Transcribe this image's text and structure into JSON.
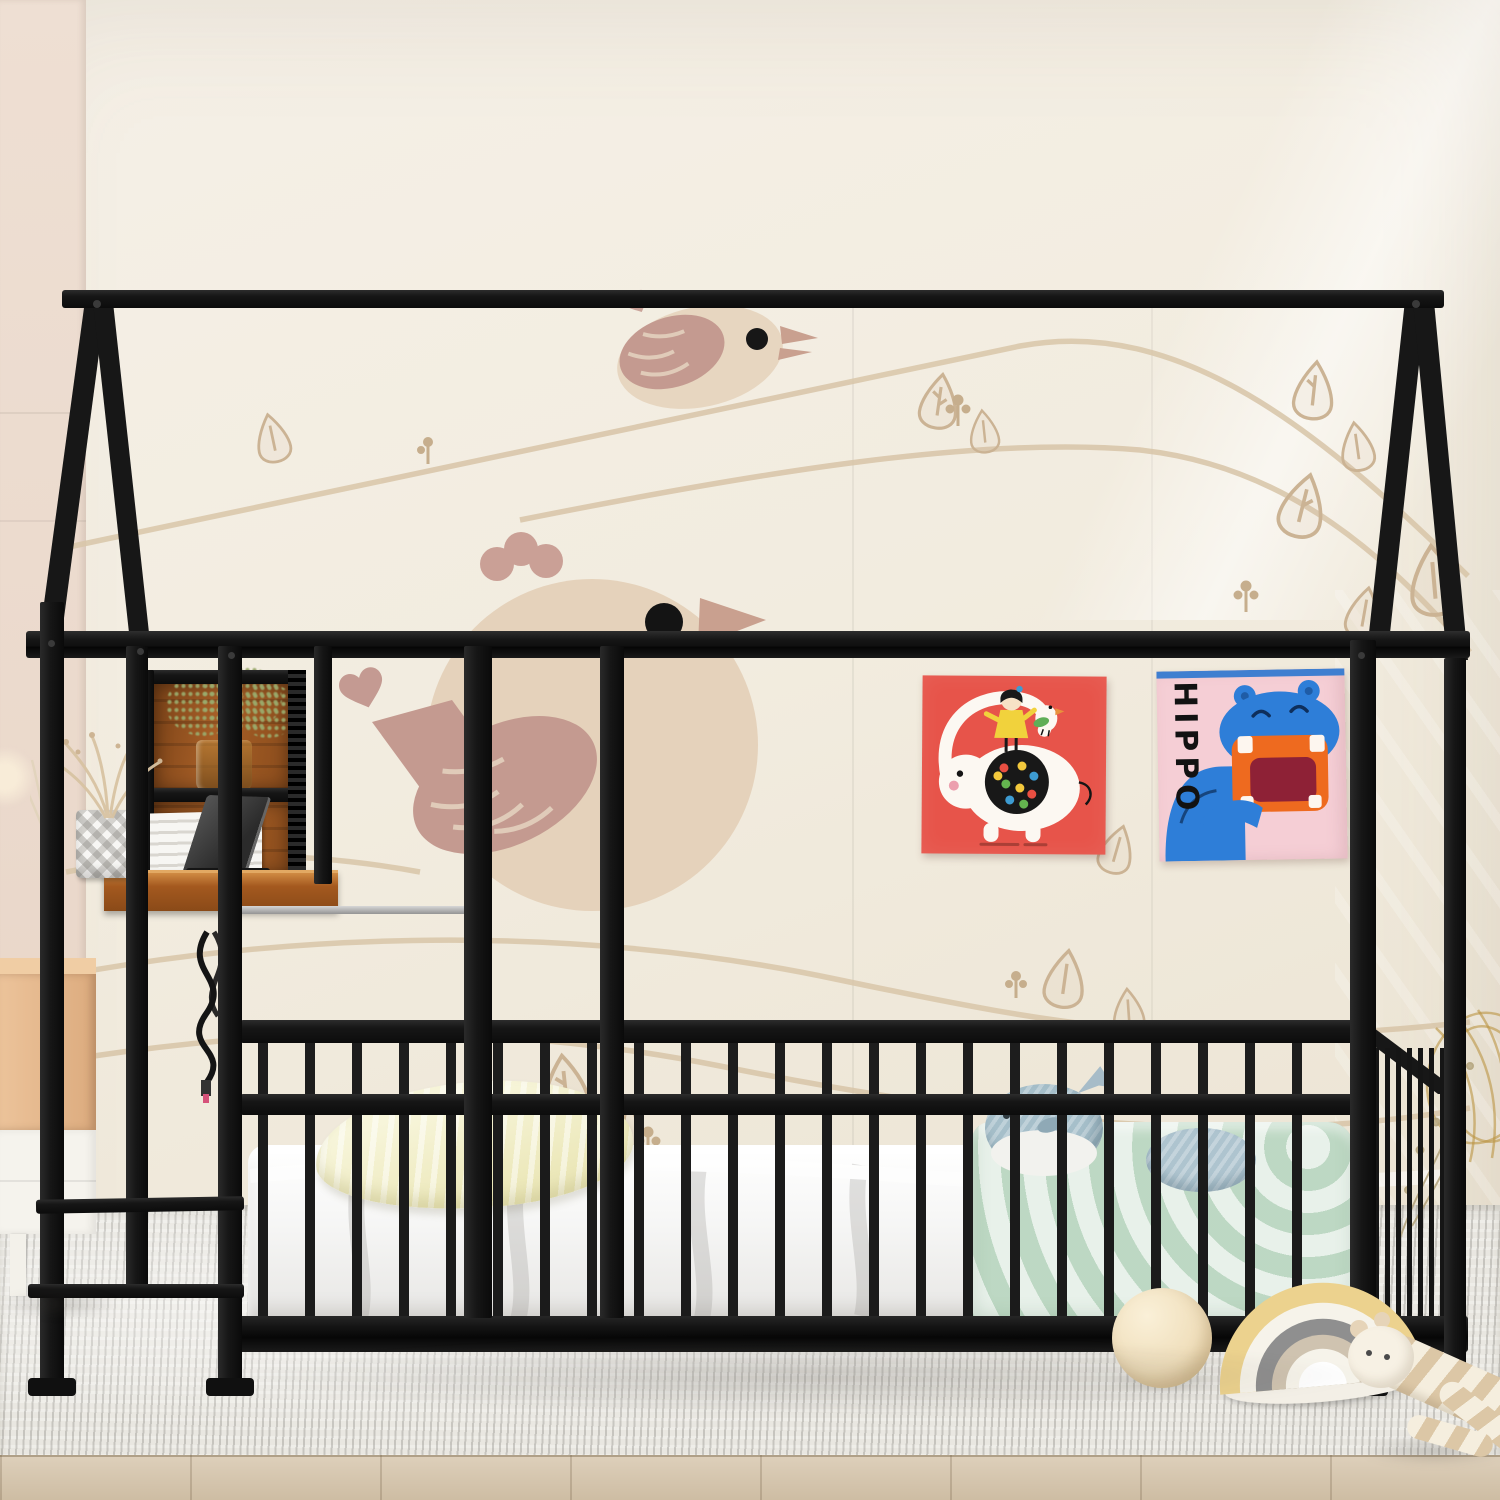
{
  "scene": {
    "subject": "Black metal house-frame kids bed with guardrail fence, built-in desk and shelf, floor mattress, wall posters and toys on a grey rug",
    "posters": {
      "hippo": {
        "text": "HIPPO"
      }
    },
    "palette": {
      "frame_black": "#1b1b1b",
      "wall_cream": "#f1ebdf",
      "wallpaper_tan": "#d4c0a4",
      "wallpaper_rose": "#c49a90",
      "desk_wood": "#a4591f",
      "pillow_yellow": "#f2efc9",
      "blanket_green": "#cde1d0",
      "whale_blue": "#a6bfca",
      "poster_red": "#e7544a",
      "poster_pink": "#f5ced5",
      "hippo_blue": "#2e7ed8",
      "hippo_mouth_orange": "#ee6a1f",
      "rug_grey": "#e9e7e1",
      "floor_wood": "#d6c7ae",
      "toy_ball_cream": "#f3e5c6",
      "stacker_yellow": "#ecd28e",
      "nightstand_wood": "#e6bb8f",
      "basket_gold": "#c39d4e"
    }
  }
}
